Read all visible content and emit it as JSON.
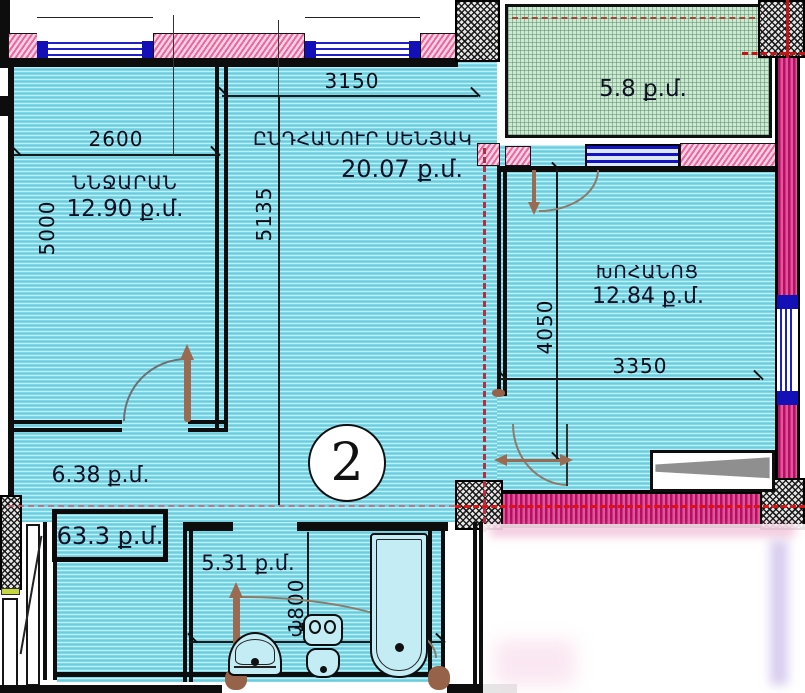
{
  "unit": {
    "number": "2"
  },
  "total": {
    "area": "63.3 ք.մ."
  },
  "rooms": {
    "bedroom": {
      "name": "ՆՆՋԱՐԱՆ",
      "area": "12.90 ք.մ."
    },
    "living": {
      "name": "ԸՆԴՀԱՆՈՒՐ ՍԵՆՅԱԿ",
      "area": "20.07 ք.մ."
    },
    "kitchen": {
      "name": "ԽՈՀԱՆՈՑ",
      "area": "12.84 ք.մ."
    },
    "balcony": {
      "area": "5.8 ք.մ."
    },
    "hallway": {
      "area": "6.38 ք.մ."
    },
    "bathroom": {
      "area": "5.31 ք.մ."
    }
  },
  "dims": {
    "bedroom_width": "2600",
    "bedroom_height": "5000",
    "living_width": "3150",
    "living_height": "5135",
    "kitchen_height": "4050",
    "kitchen_width": "3350",
    "bathroom_height": "1800",
    "bathroom_width": "3000"
  },
  "colors": {
    "room_fill": "#7cd9e9",
    "wall_pink": "#e8689f",
    "wall_crimson": "#b50e62",
    "balcony_green": "#cde9d2",
    "axis_red": "#d81616",
    "window_blue": "#1310b8",
    "door_brown": "#9a6b50"
  }
}
